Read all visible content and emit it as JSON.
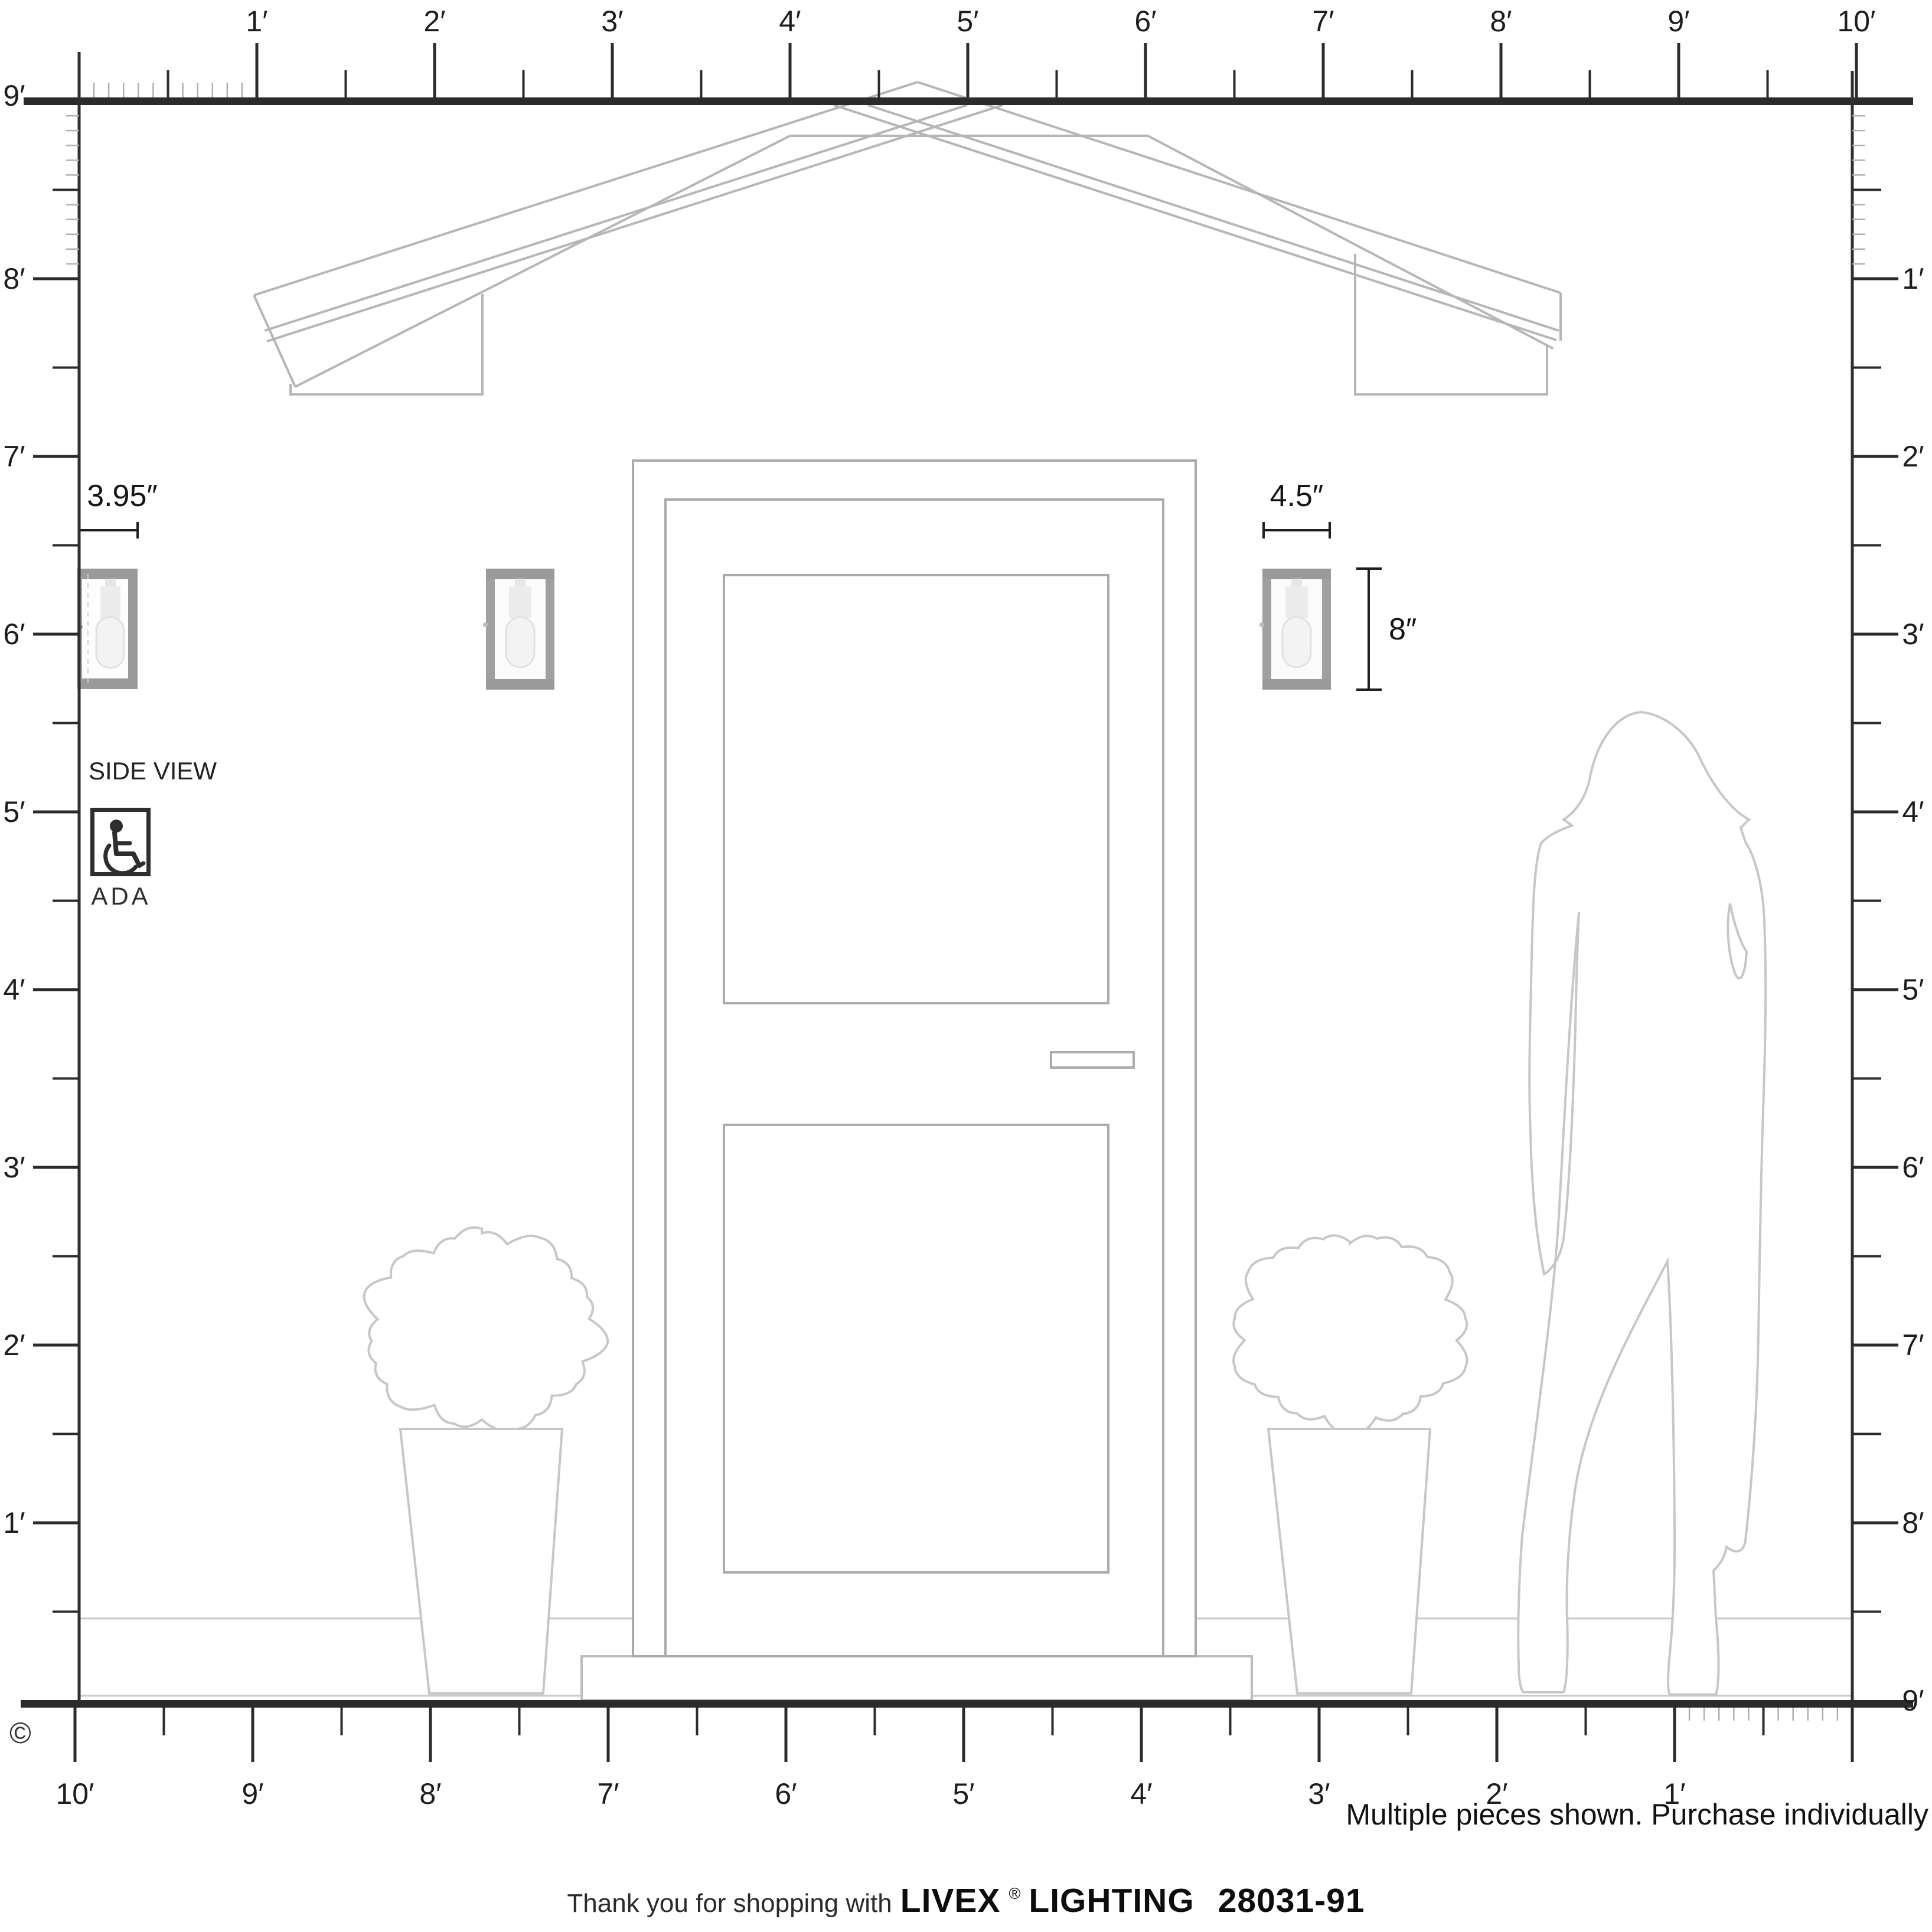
{
  "rulers": {
    "top_labels": [
      "1′",
      "2′",
      "3′",
      "4′",
      "5′",
      "6′",
      "7′",
      "8′",
      "9′",
      "10′"
    ],
    "left_labels": [
      "9′",
      "8′",
      "7′",
      "6′",
      "5′",
      "4′",
      "3′",
      "2′",
      "1′"
    ],
    "right_labels": [
      "1′",
      "2′",
      "3′",
      "4′",
      "5′",
      "6′",
      "7′",
      "8′",
      "9′"
    ],
    "bottom_labels": [
      "10′",
      "9′",
      "8′",
      "7′",
      "6′",
      "5′",
      "4′",
      "3′",
      "2′",
      "1′"
    ]
  },
  "annotations": {
    "side_width": "3.95″",
    "front_width": "4.5″",
    "front_height": "8″",
    "side_view": "SIDE VIEW",
    "ada": "ADA",
    "copyright": "©",
    "note": "Multiple pieces shown. Purchase individually"
  },
  "footer": {
    "prefix": "Thank you for shopping with",
    "brand": "LIVEX",
    "registered": "®",
    "brand_suffix": "LIGHTING",
    "sku": "28031-91"
  },
  "colors": {
    "ruler_ink": "#2b2b2b",
    "text_ink": "#1d1d1d",
    "architecture_line": "#b6b6b6",
    "door_line": "#ababab",
    "foliage_line": "#c7c7c7",
    "sconce_frame": "#9a9a9a",
    "bulb_glass": "#f3f3f3"
  }
}
